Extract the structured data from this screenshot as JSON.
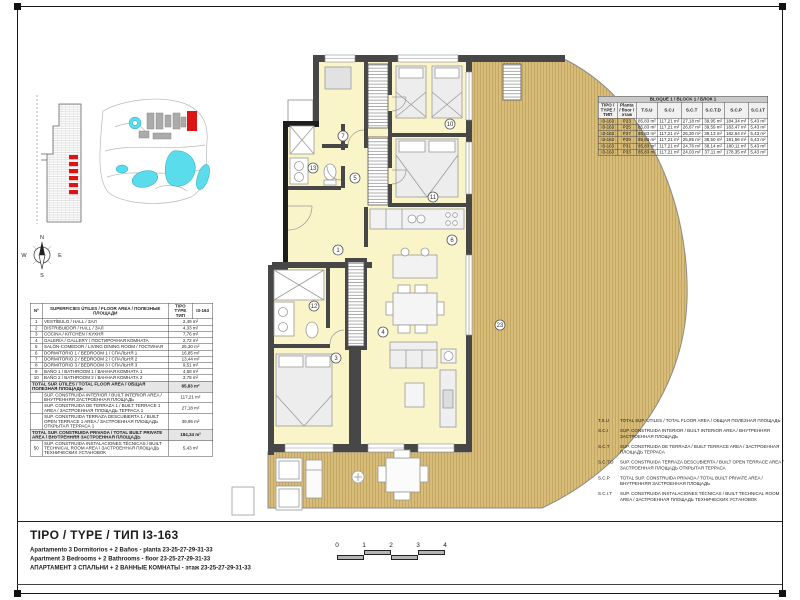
{
  "sheet": {
    "type_title": "TIPO / TYPE  / ТИП I3-163",
    "subtitle_es": "Apartamento 3 Dormitorios + 2 Baños - planta 23-25-27-29-31-33",
    "subtitle_en": "Apartment 3 Bedrooms + 2 Bathrooms - floor 23-25-27-29-31-33",
    "subtitle_ru": "АПАРТАМЕНТ 3 СПАЛЬНИ + 2 ВАННЫЕ КОМНАТЫ - этаж  23-25-27-29-31-33"
  },
  "colors": {
    "accent_red": "#dd1414",
    "pool": "#5adcec",
    "deck": "#d8bc7a",
    "deck_stripe": "#bb9d55",
    "floor": "#f9f5c9",
    "wall": "#474747"
  },
  "areas_table": {
    "header_no": "Nº",
    "header_name": "SUPERFICIES ÚTILES / FLOOR AREA / ПОЛЕЗНЫЕ ПЛОЩАДИ",
    "header_type": "TIPO TYPE ТИП",
    "header_code": "I3-163",
    "rows": [
      {
        "no": "1",
        "name": "VESTÍBULO / HALL / ЗАЛ",
        "value": "2,49 m²"
      },
      {
        "no": "2",
        "name": "DISTRIBUIDOR / HALL / ЗАЛ",
        "value": "4,33 m²"
      },
      {
        "no": "3",
        "name": "COCINA / KITCHEN / КУХНЯ",
        "value": "7,76 m²"
      },
      {
        "no": "4",
        "name": "GALERÍA / GALLERY / ПОСТИРОЧНАЯ КОМНАТА",
        "value": "2,72 m²"
      },
      {
        "no": "5",
        "name": "SALÓN-COMEDOR / LIVING DINING ROOM / ГОСТИНАЯ",
        "value": "25,30 m²"
      },
      {
        "no": "6",
        "name": "DORMITORIO 1 / BEDROOM 1 / СПАЛЬНЯ 1",
        "value": "16,85 m²"
      },
      {
        "no": "7",
        "name": "DORMITORIO 2 / BEDROOM 2 / СПАЛЬНЯ 2",
        "value": "13,44 m²"
      },
      {
        "no": "8",
        "name": "DORMITORIO 3 / BEDROOM 3 / СПАЛЬНЯ 3",
        "value": "9,51 m²"
      },
      {
        "no": "9",
        "name": "BAÑO 1 / BATHROOM 1 / ВАННАЯ КОМНАТА 1",
        "value": "4,58 m²"
      },
      {
        "no": "10",
        "name": "BAÑO 2 / BATHROOM 2 / ВАННАЯ КОМНАТА 2",
        "value": "3,78 m²"
      }
    ],
    "total_label": "TOTAL SUP. ÚTILES / TOTAL FLOOR AREA / ОБЩАЯ ПОЛЕЗНАЯ ПЛОЩАДЬ",
    "total_value": "85,83 m²",
    "built_rows": [
      {
        "no": "",
        "name": "SUP. CONSTRUIDA INTERIOR / BUILT INTERIOR AREA / ВНУТРЕННЯЯ ЗАСТРОЕННАЯ ПЛОЩАДЬ",
        "value": "117,21 m²"
      },
      {
        "no": "",
        "name": "SUP. CONSTRUIDA DE TERRAZA 1 / BUILT TERRACE 1 AREA / ЗАСТРОЕННАЯ ПЛОЩАДЬ ТЕРРАСА 1",
        "value": "27,18 m²"
      },
      {
        "no": "",
        "name": "SUP. CONSTRUIDA TERRAZA DESCUBIERTA 1 / BUILT OPEN TERRACE 1 AREA / ЗАСТРОЕННАЯ ПЛОЩАДЬ ОТКРЫТАЯ ТЕРРАСА 1",
        "value": "39,95 m²"
      }
    ],
    "private_total_label": "TOTAL SUP. CONSTRUIDA PRIVADA / TOTAL  BUILT PRIVATE AREA / ВНУТРЕННЯЯ ЗАСТРОЕННАЯ ПЛОЩАДЬ",
    "private_total_value": "184,34 m²",
    "tech_row": {
      "no": "50",
      "name": "SUP. CONSTRUIDA INSTALACIONES TÉCNICAS / BUILT TECHNICAL ROOM AREA / ЗАСТРОЕННАЯ ПЛОЩАДЬ ТЕХНИЧЕСКИХ УСТАНОВОК",
      "value": "5,43 m²"
    }
  },
  "block_table": {
    "title": "BLOQUE 1 / BLOCK 1 / БЛОК 1",
    "headers": {
      "tipo": "TIPO / TYPE / ТИП",
      "planta": "Planta / floor / этаж",
      "tsu": "T.S.U",
      "sci": "S.C.I",
      "sct": "S.C.T",
      "sctd": "S.C.T.D",
      "scp": "S.C.P",
      "scit": "S.C.I.T"
    },
    "rows": [
      {
        "tipo": "I3-163",
        "planta": "P23",
        "tsu": "85,83 m²",
        "sci": "117,21 m²",
        "sct": "27,18 m²",
        "sctd": "39,95 m²",
        "scp": "184,34 m²",
        "scit": "5,43 m²"
      },
      {
        "tipo": "I3-163",
        "planta": "P25",
        "tsu": "85,83 m²",
        "sci": "117,21 m²",
        "sct": "26,67 m²",
        "sctd": "39,59 m²",
        "scp": "183,47 m²",
        "scit": "5,43 m²"
      },
      {
        "tipo": "I3-163",
        "planta": "P27",
        "tsu": "85,83 m²",
        "sci": "117,21 m²",
        "sct": "26,30 m²",
        "sctd": "39,13 m²",
        "scp": "182,64 m²",
        "scit": "5,43 m²"
      },
      {
        "tipo": "I3-163",
        "planta": "P29",
        "tsu": "85,83 m²",
        "sci": "117,21 m²",
        "sct": "25,85 m²",
        "sctd": "38,50 m²",
        "scp": "181,56 m²",
        "scit": "5,43 m²"
      },
      {
        "tipo": "I3-163",
        "planta": "P31",
        "tsu": "85,83 m²",
        "sci": "117,21 m²",
        "sct": "24,76 m²",
        "sctd": "38,14 m²",
        "scp": "180,11 m²",
        "scit": "5,43 m²"
      },
      {
        "tipo": "I3-163",
        "planta": "P33",
        "tsu": "85,83 m²",
        "sci": "117,21 m²",
        "sct": "24,03 m²",
        "sctd": "37,11 m²",
        "scp": "178,35 m²",
        "scit": "5,43 m²"
      }
    ]
  },
  "legend": {
    "items": [
      {
        "abbr": "T.S.U",
        "text": "TOTAL SUP. ÚTILES / TOTAL FLOOR AREA / ОБЩАЯ ПОЛЕЗНАЯ ПЛОЩАДЬ"
      },
      {
        "abbr": "S.C.I",
        "text": "SUP. CONSTRUIDA INTERIOR / BUILT INTERIOR AREA / ВНУТРЕННЯЯ ЗАСТРОЕННАЯ ПЛОЩАДЬ"
      },
      {
        "abbr": "S.C.T",
        "text": "SUP. CONSTRUIDA DE TERRAZA / BUILT TERRACE AREA / ЗАСТРОЕННАЯ ПЛОЩАДЬ ТЕРРАСА"
      },
      {
        "abbr": "S.C.T.D",
        "text": "SUP. CONSTRUIDA TERRAZA DESCUBIERTA / BUILT OPEN TERRACE AREA / ЗАСТРОЕННАЯ ПЛОЩАДЬ ОТКРЫТАЯ ТЕРРАСА"
      },
      {
        "abbr": "S.C.P",
        "text": "TOTAL SUP. CONSTRUIDA PRIVADA / TOTAL BUILT PRIVATE AREA / ВНУТРЕННЯЯ ЗАСТРОЕННАЯ ПЛОЩАДЬ"
      },
      {
        "abbr": "S.C.I.T",
        "text": "SUP. CONSTRUIDA INSTALACIONES TÉCNICAS / BUILT TECHNICAL ROOM AREA / ЗАСТРОЕННАЯ ПЛОЩАДЬ ТЕХНИЧЕСКИХ УСТАНОВОК"
      }
    ]
  },
  "scale_bar": {
    "labels": [
      "0",
      "1",
      "2",
      "3",
      "4"
    ]
  },
  "compass": {
    "n": "N",
    "e": "E",
    "s": "S",
    "w": "W"
  },
  "floor_plan": {
    "room_numbers": [
      "7",
      "10",
      "11",
      "13",
      "5",
      "1",
      "6",
      "12",
      "3",
      "4",
      "23"
    ]
  }
}
